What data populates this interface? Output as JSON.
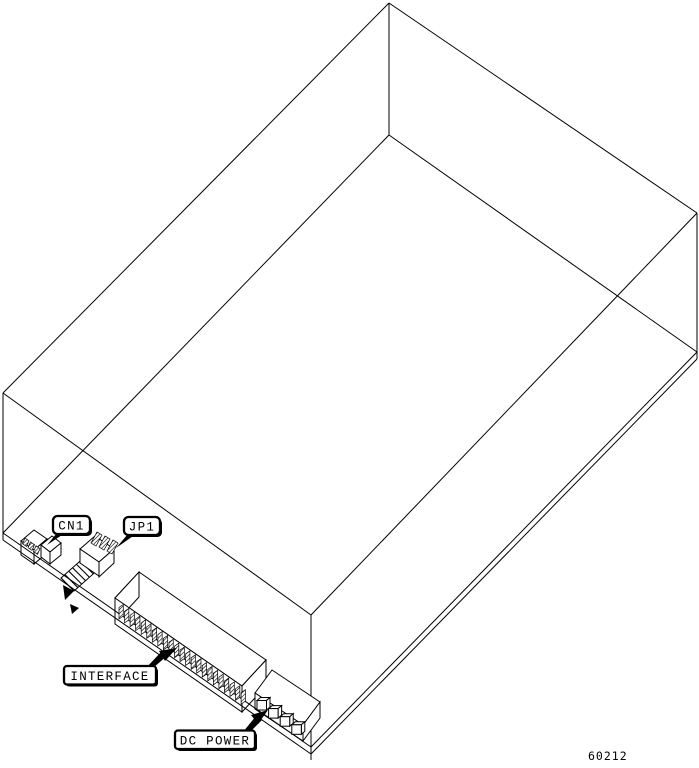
{
  "figure": {
    "number": "60212"
  },
  "callouts": {
    "cn1": {
      "label": "CN1"
    },
    "jp1": {
      "label": "JP1"
    },
    "interface": {
      "label": "INTERFACE"
    },
    "dc_power": {
      "label": "DC POWER"
    }
  },
  "connectors": {
    "interface": {
      "pin_count": 23
    },
    "dc_power": {
      "pin_count": 4
    },
    "jp1": {
      "blade_count": 3,
      "stripe_count": 8
    },
    "cn1": {
      "slot_count": 3
    }
  },
  "colors": {
    "line": "#000000",
    "background": "#ffffff"
  }
}
